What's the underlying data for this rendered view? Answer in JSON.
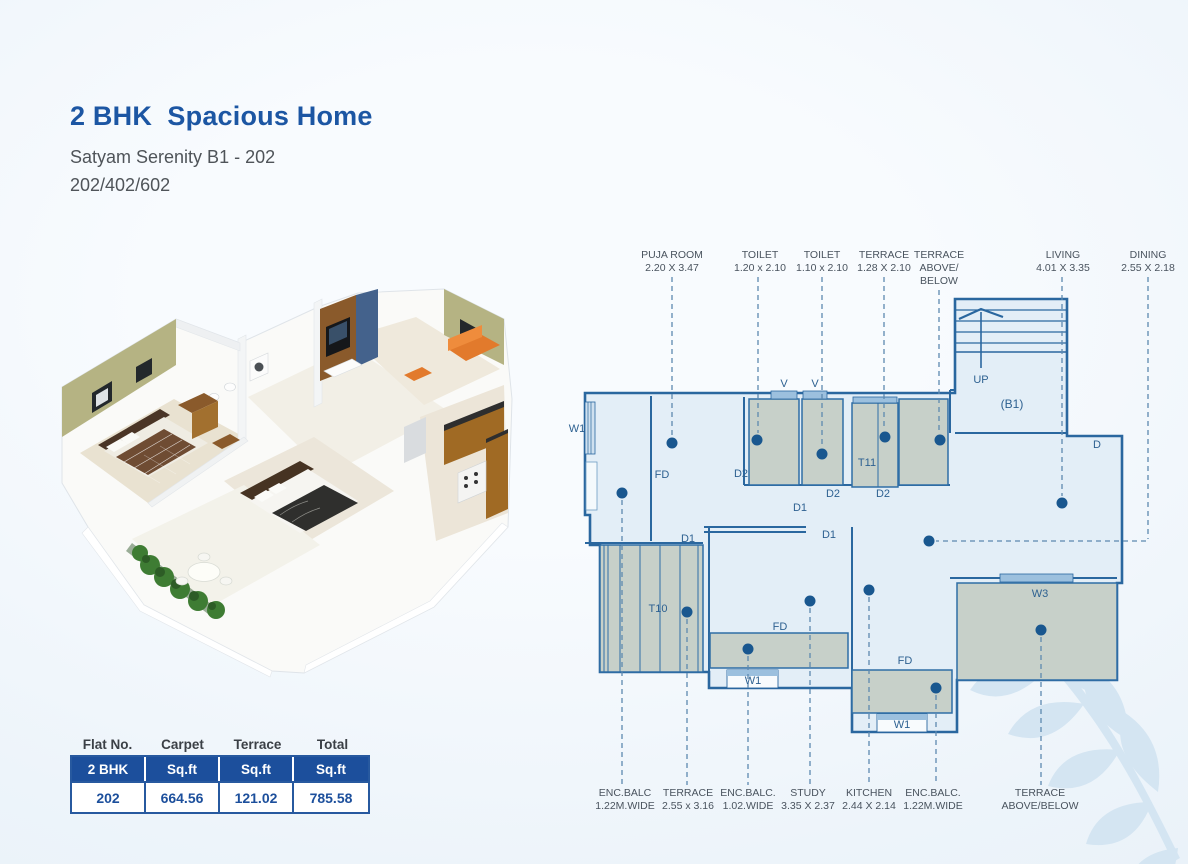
{
  "header": {
    "title": "2 BHK  Spacious Home",
    "subtitle": "Satyam Serenity B1 - 202",
    "variants": "202/402/602"
  },
  "area_table": {
    "columns": [
      "Flat No.",
      "Carpet",
      "Terrace",
      "Total"
    ],
    "unit_row": [
      "2 BHK",
      "Sq.ft",
      "Sq.ft",
      "Sq.ft"
    ],
    "values_row": [
      "202",
      "664.56",
      "121.02",
      "785.58"
    ]
  },
  "floorplan": {
    "top_labels": [
      {
        "line1": "PUJA ROOM",
        "line2": "2.20 X 3.47"
      },
      {
        "line1": "TOILET",
        "line2": "1.20 x 2.10"
      },
      {
        "line1": "TOILET",
        "line2": "1.10 x 2.10"
      },
      {
        "line1": "TERRACE",
        "line2": "1.28 X 2.10"
      },
      {
        "line1": "TERRACE",
        "line2": "ABOVE/",
        "line3": "BELOW"
      },
      {
        "line1": "LIVING",
        "line2": "4.01 X 3.35"
      },
      {
        "line1": "DINING",
        "line2": "2.55 X 2.18"
      }
    ],
    "bottom_labels": [
      {
        "line1": "ENC.BALC",
        "line2": "1.22M.WIDE"
      },
      {
        "line1": "TERRACE",
        "line2": "2.55 x 3.16"
      },
      {
        "line1": "ENC.BALC.",
        "line2": "1.02.WIDE"
      },
      {
        "line1": "STUDY",
        "line2": "3.35 X 2.37"
      },
      {
        "line1": "KITCHEN",
        "line2": "2.44 X 2.14"
      },
      {
        "line1": "ENC.BALC.",
        "line2": "1.22M.WIDE"
      },
      {
        "line1": "TERRACE",
        "line2": "ABOVE/BELOW"
      }
    ],
    "marks": {
      "w1_left": "W1",
      "fd_bedroom": "FD",
      "v1": "V",
      "v2": "V",
      "d2_left": "D2",
      "d2_mid": "D2",
      "d2_right": "D2",
      "t11": "T11",
      "d1_corridor": "D1",
      "d1_t10": "D1",
      "d1_study": "D1",
      "t10": "T10",
      "fd_study": "FD",
      "w1_study": "W1",
      "fd_kitchen": "FD",
      "w1_kitchen": "W1",
      "w3": "W3",
      "d_living": "D",
      "up": "UP",
      "b1": "(B1)"
    }
  },
  "colors": {
    "accent_blue": "#1c56a3",
    "table_blue": "#1c4f9c",
    "wall_stroke": "#2a679f",
    "floor_fill": "#e3eef7",
    "room_fill": "#c7d0c9",
    "dot_fill": "#19578f"
  }
}
